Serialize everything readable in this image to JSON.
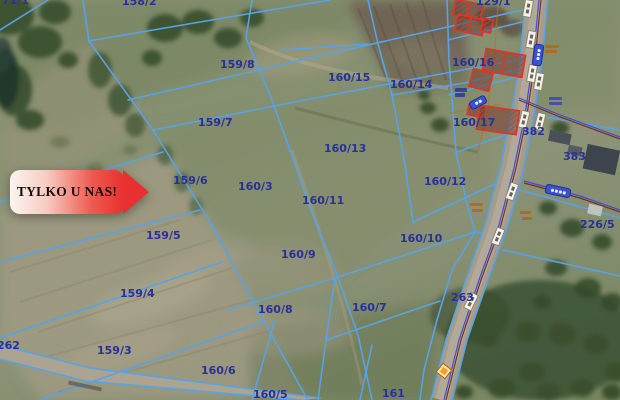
{
  "banner": {
    "text": "TYLKO U NAS!"
  },
  "map": {
    "kind": "cadastral-aerial-map",
    "parcel_labels": [
      {
        "label": "71/1",
        "x": 2,
        "y": -5
      },
      {
        "label": "158/2",
        "x": 122,
        "y": -4
      },
      {
        "label": "129/1",
        "x": 476,
        "y": -4
      },
      {
        "label": "160/16",
        "x": 452,
        "y": 57
      },
      {
        "label": "159/8",
        "x": 220,
        "y": 59
      },
      {
        "label": "160/15",
        "x": 328,
        "y": 72
      },
      {
        "label": "160/14",
        "x": 390,
        "y": 79
      },
      {
        "label": "159/7",
        "x": 198,
        "y": 117
      },
      {
        "label": "160/17",
        "x": 453,
        "y": 117
      },
      {
        "label": "382",
        "x": 522,
        "y": 126
      },
      {
        "label": "160/13",
        "x": 324,
        "y": 143
      },
      {
        "label": "383",
        "x": 563,
        "y": 151
      },
      {
        "label": "159/6",
        "x": 173,
        "y": 175
      },
      {
        "label": "160/3",
        "x": 238,
        "y": 181
      },
      {
        "label": "160/12",
        "x": 424,
        "y": 176
      },
      {
        "label": "160/11",
        "x": 302,
        "y": 195
      },
      {
        "label": "159/5",
        "x": 146,
        "y": 230
      },
      {
        "label": "160/10",
        "x": 400,
        "y": 233
      },
      {
        "label": "226/5",
        "x": 580,
        "y": 219
      },
      {
        "label": "160/9",
        "x": 281,
        "y": 249
      },
      {
        "label": "159/4",
        "x": 120,
        "y": 288
      },
      {
        "label": "160/8",
        "x": 258,
        "y": 304
      },
      {
        "label": "160/7",
        "x": 352,
        "y": 302
      },
      {
        "label": "263",
        "x": 451,
        "y": 292
      },
      {
        "label": "159/3",
        "x": 97,
        "y": 345
      },
      {
        "label": "262",
        "x": -3,
        "y": 340
      },
      {
        "label": "160/6",
        "x": 201,
        "y": 365
      },
      {
        "label": "160/5",
        "x": 253,
        "y": 389
      },
      {
        "label": "161",
        "x": 382,
        "y": 388
      }
    ],
    "colors": {
      "parcel_line": "#57a3e6",
      "parcel_label": "#27309b",
      "building_outline": "#d8382a",
      "banner_red": "#e93030",
      "road_fill": "#a59c8c",
      "utility_blue": "#3b51d6",
      "utility_red": "#7a2f23",
      "annotation_orange": "#c06018"
    },
    "icons": {
      "road_marker": "white-chip",
      "road_name_label": "blue-pill",
      "poi_marker": "orange-diamond"
    }
  }
}
